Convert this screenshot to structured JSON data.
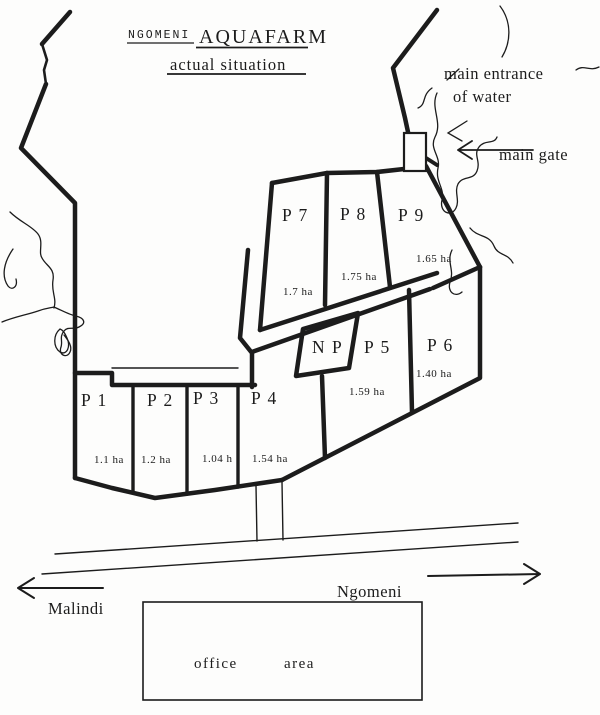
{
  "title": {
    "prefix": "NGOMENI",
    "main": "AQUAFARM",
    "subtitle": "actual situation"
  },
  "annotations": {
    "main_entrance_line1": "main entrance",
    "main_entrance_line2": "of water",
    "main_gate": "main gate"
  },
  "plots": [
    {
      "id": "p1",
      "name": "P 1",
      "area": "1.1 ha"
    },
    {
      "id": "p2",
      "name": "P 2",
      "area": "1.2 ha"
    },
    {
      "id": "p3",
      "name": "P 3",
      "area": "1.04 h"
    },
    {
      "id": "p4",
      "name": "P 4",
      "area": "1.54 ha"
    },
    {
      "id": "p5",
      "name": "P 5",
      "area": "1.59 ha"
    },
    {
      "id": "p6",
      "name": "P 6",
      "area": "1.40 ha"
    },
    {
      "id": "p7",
      "name": "P 7",
      "area": "1.7 ha"
    },
    {
      "id": "p8",
      "name": "P 8",
      "area": "1.75 ha"
    },
    {
      "id": "p9",
      "name": "P 9",
      "area": "1.65 ha"
    },
    {
      "id": "np",
      "name": "N P",
      "area": ""
    }
  ],
  "roads": {
    "west_label": "Malindi",
    "east_label": "Ngomeni"
  },
  "office": {
    "word1": "office",
    "word2": "area"
  },
  "colors": {
    "ink": "#1c1c1c",
    "paper": "#fdfdfc"
  }
}
